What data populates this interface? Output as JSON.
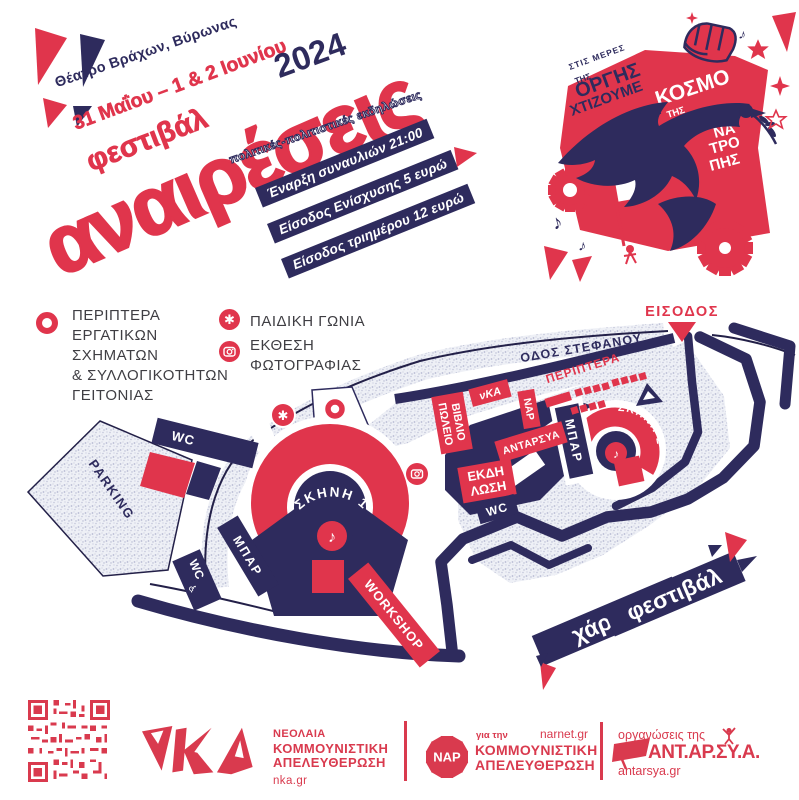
{
  "poster": {
    "venue": "Θέατρο Βράχων, Βύρωνας",
    "dates": "31 Μαΐου – 1 & 2 Ιουνίου",
    "year": "2024",
    "festival_word": "φεστιβάλ",
    "title": "αναιρέσεις",
    "subtitle": "πολιτικές-πολιτιστικές εκδηλώσεις",
    "badge1": "Έναρξη συναυλιών 21:00",
    "badge2": "Είσοδος Ενίσχυσης 5 ευρώ",
    "badge3": "Είσοδος τριημέρου 12 ευρώ"
  },
  "logo": {
    "slogan_top1": "ΣΤΙΣ ΜΕΡΕΣ",
    "slogan_top2": "ΤΗΣ",
    "slogan_orgis": "ΟΡΓΗΣ",
    "slogan_xtizoume": "ΧΤΙΖΟΥΜΕ",
    "slogan_ton": "ΤΟΝ",
    "world_kosmo": "ΚΟΣΜΟ",
    "world_tis": "ΤΗΣ",
    "world_a": "Α",
    "world_na": "ΝΑ",
    "world_tro": "ΤΡΟ",
    "world_pis": "ΠΗΣ"
  },
  "legend": {
    "item1_line1": "ΠΕΡΙΠΤΕΡΑ",
    "item1_line2": "ΕΡΓΑΤΙΚΩΝ",
    "item1_line3": "ΣΧΗΜΑΤΩΝ",
    "item1_line4": "& ΣΥΛΛΟΓΙΚΟΤΗΤΩΝ",
    "item1_line5": "ΓΕΙΤΟΝΙΑΣ",
    "item2_label": "ΠΑΙΔΙΚΗ ΓΩΝΙΑ",
    "item3_line1": "ΕΚΘΕΣΗ",
    "item3_line2": "ΦΩΤΟΓΡΑΦΙΑΣ"
  },
  "map": {
    "entrance": "ΕΙΣΟΔΟΣ",
    "street": "ΟΔΟΣ ΣΤΕΦΑΝΟΥ",
    "kiosks": "ΠΕΡΙΠΤΕΡΑ",
    "bookstore_line1": "ΒΙΒΛΙΟ",
    "bookstore_line2": "ΠΩΛΕΙΟ",
    "nka_box": "νΚΑ",
    "nar_box": "ΝΑΡ",
    "antarsya_box": "ΑΝΤΑΡΣΥΑ",
    "bar_left": "ΜΠΑΡ",
    "bar_right": "ΜΠΑΡ",
    "event_line1": "ΕΚΔΗ",
    "event_line2": "ΛΩΣΗ",
    "stage1": "ΣΚΗΝΗ 1",
    "stage2": "ΣΚΗΝΗ 2",
    "wc_top": "WC",
    "wc_bottom": "WC",
    "wc_right": "WC",
    "wheelchair": "♿",
    "note": "♪",
    "asterisk": "✱",
    "workshop": "WORKSHOP",
    "parking": "PARKING",
    "title_line1": "χάρτης",
    "title_line2": "φεστιβάλ"
  },
  "footer": {
    "nka_logo": "νΚΑ",
    "nka_line1": "ΝΕΟΛΑΙΑ",
    "nka_line2": "ΚΟΜΜΟΥΝΙΣΤΙΚΗ",
    "nka_line3": "ΑΠΕΛΕΥΘΕΡΩΣΗ",
    "nka_url": "nka.gr",
    "nar_logo": "ΝΑΡ",
    "nar_tagline": "για την",
    "nar_url": "narnet.gr",
    "nar_line1": "ΚΟΜΜΟΥΝΙΣΤΙΚΗ",
    "nar_line2": "ΑΠΕΛΕΥΘΕΡΩΣΗ",
    "antarsya_tagline": "οργανώσεις της",
    "antarsya_name": "ΑΝΤ.ΑΡ.ΣΥ.Α.",
    "antarsya_url": "antarsya.gr"
  },
  "colors": {
    "red": "#e0354c",
    "navy": "#2e2b5d",
    "line": "#232048",
    "text_dark": "#3f3e43"
  }
}
